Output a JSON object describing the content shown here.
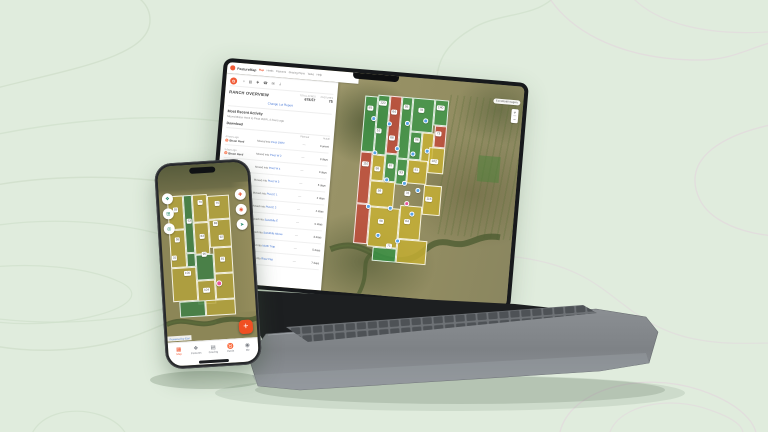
{
  "background": {
    "color": "#e0ecdd"
  },
  "colors": {
    "accent_orange": "#f0512a",
    "field_green": "rgba(56,150,70,0.78)",
    "field_red": "rgba(196,72,58,0.8)",
    "field_yellow": "rgba(200,177,51,0.82)",
    "marker_blue": "#57a3e8",
    "marker_pink": "#e8569a"
  },
  "laptop": {
    "header": {
      "brand": "PastureMap",
      "nav": [
        "Map",
        "Herds",
        "Pastures",
        "Grazing Plans",
        "Tasks",
        "Help"
      ]
    },
    "toolbar": [
      "○",
      "▤",
      "✚",
      "☎",
      "✉",
      "⇣"
    ],
    "panel": {
      "title": "RANCH OVERVIEW",
      "stats": [
        {
          "label": "TOTAL ACRES",
          "value": "678.57"
        },
        {
          "label": "PASTURES",
          "value": "75"
        }
      ],
      "report_link": "Change Lot Report",
      "activity_title": "Most Recent Activity",
      "activity_subtitle": "Moved Bison Herd to Pivot OWN, 4 hours ago",
      "download_label": "Download",
      "table": {
        "planned_header": "Planned",
        "actual_header": "Actual",
        "herd_icon": "♉",
        "rows": [
          {
            "when": "4 hours ago",
            "herd": "Bison Herd",
            "action": "Moved into",
            "target": "Pivot OWN",
            "planned": "—",
            "actual": "Current"
          },
          {
            "when": "3 days ago",
            "herd": "Bison Herd",
            "action": "Moved into",
            "target": "Pivot W 2",
            "planned": "—",
            "actual": "3 days"
          },
          {
            "when": "6 days ago",
            "herd": "Bison Herd",
            "action": "Moved into",
            "target": "Pivot W 4",
            "planned": "—",
            "actual": "3 days"
          },
          {
            "when": "1 week ago",
            "herd": "Bison Herd",
            "action": "Moved into",
            "target": "Pivot W 3",
            "planned": "—",
            "actual": "5 days"
          },
          {
            "when": "2 weeks ago",
            "herd": "Bison Herd",
            "action": "Moved into",
            "target": "Pivot E 1",
            "planned": "—",
            "actual": "2 days"
          },
          {
            "when": "2 weeks ago",
            "herd": "Bison Herd",
            "action": "Moved into",
            "target": "Pivot E 2",
            "planned": "—",
            "actual": "4 days"
          },
          {
            "when": "3 weeks ago",
            "herd": "Bison Herd",
            "action": "Moved into",
            "target": "Sandhills E",
            "planned": "—",
            "actual": "6 days"
          },
          {
            "when": "3 weeks ago",
            "herd": "Bison Herd",
            "action": "Moved into",
            "target": "Sandhills Above",
            "planned": "—",
            "actual": "3 days"
          },
          {
            "when": "1 month ago",
            "herd": "Bison Herd",
            "action": "Moved into",
            "target": "North Trap",
            "planned": "—",
            "actual": "5 days"
          },
          {
            "when": "1 month ago",
            "herd": "Bison Herd",
            "action": "Moved into",
            "target": "River Flat",
            "planned": "—",
            "actual": "7 days"
          }
        ]
      }
    },
    "map": {
      "basemap_label": "Esri World Imagery",
      "zoom_in": "+",
      "zoom_out": "−",
      "fields": [
        {
          "x": 0,
          "y": 2,
          "w": 13,
          "h": 56,
          "c": "rgba(56,150,70,0.78)"
        },
        {
          "x": 13,
          "y": 0,
          "w": 12,
          "h": 60,
          "c": "rgba(56,150,70,0.78)"
        },
        {
          "x": 25,
          "y": 0,
          "w": 12,
          "h": 58,
          "c": "rgba(196,72,58,0.8)"
        },
        {
          "x": 37,
          "y": 0,
          "w": 11,
          "h": 62,
          "c": "rgba(56,150,70,0.78)"
        },
        {
          "x": 48,
          "y": 0,
          "w": 22,
          "h": 34,
          "c": "rgba(56,150,70,0.78)"
        },
        {
          "x": 70,
          "y": 0,
          "w": 14,
          "h": 26,
          "c": "rgba(56,150,70,0.78)"
        },
        {
          "x": 48,
          "y": 34,
          "w": 12,
          "h": 28,
          "c": "rgba(56,150,70,0.78)"
        },
        {
          "x": 60,
          "y": 34,
          "w": 12,
          "h": 30,
          "c": "rgba(200,177,51,0.82)"
        },
        {
          "x": 72,
          "y": 26,
          "w": 12,
          "h": 22,
          "c": "rgba(196,72,58,0.8)"
        },
        {
          "x": 0,
          "y": 58,
          "w": 12,
          "h": 52,
          "c": "rgba(196,72,58,0.8)"
        },
        {
          "x": 12,
          "y": 60,
          "w": 13,
          "h": 26,
          "c": "rgba(200,177,51,0.82)"
        },
        {
          "x": 25,
          "y": 58,
          "w": 12,
          "h": 28,
          "c": "rgba(56,150,70,0.78)"
        },
        {
          "x": 37,
          "y": 62,
          "w": 11,
          "h": 26,
          "c": "rgba(56,150,70,0.78)"
        },
        {
          "x": 12,
          "y": 86,
          "w": 25,
          "h": 26,
          "c": "rgba(200,177,51,0.82)"
        },
        {
          "x": 48,
          "y": 62,
          "w": 20,
          "h": 24,
          "c": "rgba(200,177,51,0.82)"
        },
        {
          "x": 68,
          "y": 48,
          "w": 16,
          "h": 26,
          "c": "rgba(200,177,51,0.82)"
        },
        {
          "x": 0,
          "y": 110,
          "w": 14,
          "h": 40,
          "c": "rgba(196,72,58,0.8)"
        },
        {
          "x": 14,
          "y": 112,
          "w": 30,
          "h": 40,
          "c": "rgba(200,177,51,0.82)"
        },
        {
          "x": 44,
          "y": 108,
          "w": 22,
          "h": 34,
          "c": "rgba(200,177,51,0.82)"
        },
        {
          "x": 66,
          "y": 86,
          "w": 18,
          "h": 30,
          "c": "rgba(200,177,51,0.82)"
        },
        {
          "x": 44,
          "y": 142,
          "w": 30,
          "h": 24,
          "c": "rgba(200,177,51,0.82)"
        },
        {
          "x": 20,
          "y": 152,
          "w": 24,
          "h": 14,
          "c": "rgba(56,150,70,0.78)"
        }
      ],
      "labels": [
        {
          "t": "85",
          "x": 6,
          "y": 14
        },
        {
          "t": "120",
          "x": 18,
          "y": 8
        },
        {
          "t": "64",
          "x": 30,
          "y": 16
        },
        {
          "t": "95",
          "x": 42,
          "y": 10
        },
        {
          "t": "78",
          "x": 57,
          "y": 12
        },
        {
          "t": "140",
          "x": 76,
          "y": 8
        },
        {
          "t": "52",
          "x": 16,
          "y": 36
        },
        {
          "t": "88",
          "x": 30,
          "y": 42
        },
        {
          "t": "96",
          "x": 55,
          "y": 42
        },
        {
          "t": "73",
          "x": 76,
          "y": 34
        },
        {
          "t": "110",
          "x": 6,
          "y": 70
        },
        {
          "t": "58",
          "x": 18,
          "y": 74
        },
        {
          "t": "67",
          "x": 31,
          "y": 70
        },
        {
          "t": "93",
          "x": 42,
          "y": 76
        },
        {
          "t": "81",
          "x": 57,
          "y": 72
        },
        {
          "t": "102",
          "x": 74,
          "y": 62
        },
        {
          "t": "59",
          "x": 22,
          "y": 96
        },
        {
          "t": "76",
          "x": 50,
          "y": 96
        },
        {
          "t": "116",
          "x": 72,
          "y": 100
        },
        {
          "t": "98",
          "x": 26,
          "y": 126
        },
        {
          "t": "84",
          "x": 52,
          "y": 124
        },
        {
          "t": "71",
          "x": 36,
          "y": 150
        }
      ],
      "markers": [
        {
          "x": 10,
          "y": 24
        },
        {
          "x": 26,
          "y": 28
        },
        {
          "x": 44,
          "y": 26
        },
        {
          "x": 62,
          "y": 22
        },
        {
          "x": 36,
          "y": 52
        },
        {
          "x": 52,
          "y": 56
        },
        {
          "x": 14,
          "y": 58
        },
        {
          "x": 66,
          "y": 52
        },
        {
          "x": 28,
          "y": 84
        },
        {
          "x": 46,
          "y": 86
        },
        {
          "x": 60,
          "y": 92
        },
        {
          "x": 12,
          "y": 112
        },
        {
          "x": 34,
          "y": 112
        },
        {
          "x": 56,
          "y": 116
        },
        {
          "x": 24,
          "y": 140
        },
        {
          "x": 44,
          "y": 144
        },
        {
          "x": 50,
          "y": 106,
          "c": "#e8569a"
        }
      ]
    }
  },
  "phone": {
    "left_buttons": [
      {
        "glyph": "❖",
        "color": "#2a8c6e",
        "x": 3,
        "y": 27
      },
      {
        "glyph": "⊞",
        "color": "#2a8c6e",
        "x": 3,
        "y": 42
      },
      {
        "glyph": "◎",
        "color": "#2a8c6e",
        "x": 3,
        "y": 57
      }
    ],
    "right_buttons": [
      {
        "glyph": "✚",
        "color": "#e8512e",
        "x": 76,
        "y": 27
      },
      {
        "glyph": "◉",
        "color": "#e8512e",
        "x": 76,
        "y": 42
      },
      {
        "glyph": "➤",
        "color": "#2a8c6e",
        "x": 76,
        "y": 57
      }
    ],
    "fab_label": "+",
    "attribution": "Powered by Esri",
    "fields": [
      {
        "x": 0,
        "y": 0,
        "w": 16,
        "h": 34,
        "c": "rgba(181,163,60,0.82)"
      },
      {
        "x": 16,
        "y": 0,
        "w": 9,
        "h": 58,
        "c": "rgba(62,127,69,0.85)"
      },
      {
        "x": 25,
        "y": 0,
        "w": 15,
        "h": 28,
        "c": "rgba(181,163,60,0.82)"
      },
      {
        "x": 40,
        "y": 2,
        "w": 22,
        "h": 24,
        "c": "rgba(181,163,60,0.82)"
      },
      {
        "x": 0,
        "y": 34,
        "w": 16,
        "h": 38,
        "c": "rgba(181,163,60,0.82)"
      },
      {
        "x": 25,
        "y": 28,
        "w": 15,
        "h": 32,
        "c": "rgba(181,163,60,0.82)"
      },
      {
        "x": 40,
        "y": 26,
        "w": 22,
        "h": 28,
        "c": "rgba(181,163,60,0.82)"
      },
      {
        "x": 0,
        "y": 72,
        "w": 25,
        "h": 34,
        "c": "rgba(181,163,60,0.82)"
      },
      {
        "x": 16,
        "y": 58,
        "w": 9,
        "h": 14,
        "c": "rgba(62,127,69,0.85)"
      },
      {
        "x": 25,
        "y": 60,
        "w": 18,
        "h": 26,
        "c": "rgba(62,127,69,0.85)"
      },
      {
        "x": 43,
        "y": 54,
        "w": 19,
        "h": 26,
        "c": "rgba(181,163,60,0.82)"
      },
      {
        "x": 25,
        "y": 86,
        "w": 18,
        "h": 24,
        "c": "rgba(181,163,60,0.82)"
      },
      {
        "x": 43,
        "y": 80,
        "w": 19,
        "h": 26,
        "c": "rgba(181,163,60,0.82)"
      },
      {
        "x": 6,
        "y": 106,
        "w": 26,
        "h": 16,
        "c": "rgba(62,127,69,0.85)"
      },
      {
        "x": 32,
        "y": 106,
        "w": 30,
        "h": 16,
        "c": "rgba(181,163,60,0.82)"
      }
    ],
    "labels": [
      {
        "t": "55",
        "x": 8,
        "y": 14
      },
      {
        "t": "70",
        "x": 33,
        "y": 8
      },
      {
        "t": "76",
        "x": 50,
        "y": 10
      },
      {
        "t": "63",
        "x": 21,
        "y": 26
      },
      {
        "t": "88",
        "x": 47,
        "y": 30
      },
      {
        "t": "58",
        "x": 8,
        "y": 44
      },
      {
        "t": "83",
        "x": 33,
        "y": 42
      },
      {
        "t": "92",
        "x": 52,
        "y": 44
      },
      {
        "t": "31",
        "x": 4,
        "y": 62
      },
      {
        "t": "96",
        "x": 34,
        "y": 60
      },
      {
        "t": "100",
        "x": 16,
        "y": 78
      },
      {
        "t": "81",
        "x": 52,
        "y": 66
      },
      {
        "t": "104",
        "x": 34,
        "y": 96
      }
    ],
    "markers": [
      {
        "x": 47,
        "y": 90,
        "c": "#e8569a"
      }
    ],
    "tabs": [
      {
        "label": "Map",
        "glyph": "▦",
        "active": true
      },
      {
        "label": "Pastures",
        "glyph": "❖"
      },
      {
        "label": "Grazing",
        "glyph": "▤"
      },
      {
        "label": "Herds",
        "glyph": "♉"
      },
      {
        "label": "Me",
        "glyph": "◉"
      }
    ]
  }
}
